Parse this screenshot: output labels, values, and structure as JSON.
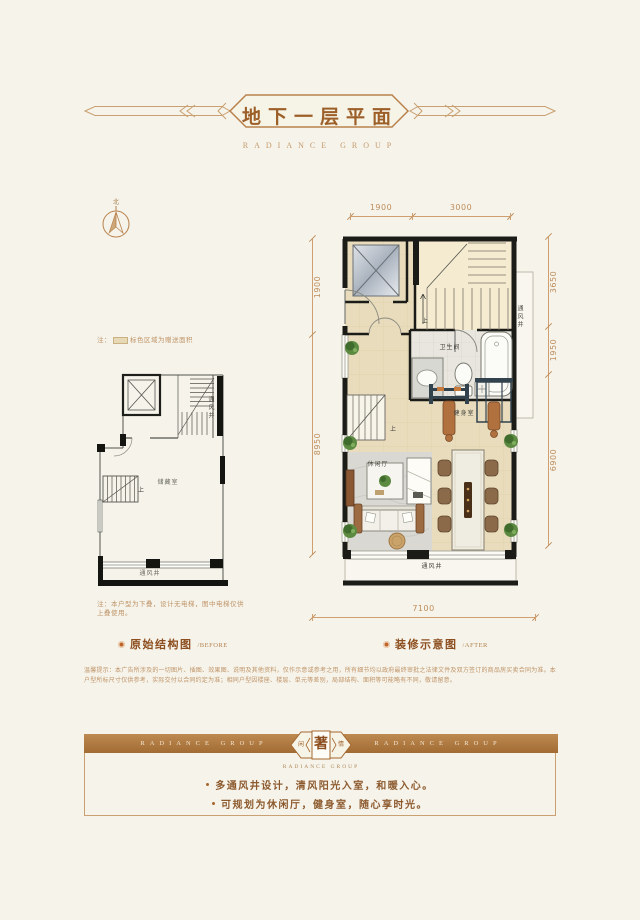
{
  "header": {
    "title": "地下一层平面",
    "brand": "RADIANCE GROUP"
  },
  "compass": {
    "label": "北"
  },
  "plan_before": {
    "note_top_prefix": "注：",
    "note_top_text": "标色区域为赠送面积",
    "room_label": "储藏室",
    "vent_right": "通风井",
    "vent_bottom": "通风井",
    "stair_up": "上",
    "note_bottom": "注：本户型为下叠，设计无电梯，图中电梯仅供上叠使用。",
    "caption": "原始结构图",
    "caption_en": "/BEFORE"
  },
  "plan_after": {
    "bathroom": "卫生间",
    "gym": "健身室",
    "lounge": "休闲厅",
    "vent_right": "通风井",
    "vent_bottom": "通风井",
    "stair_up": "上",
    "stair_up2": "上",
    "caption": "装修示意图",
    "caption_en": "/AFTER",
    "dims": {
      "top1": "1900",
      "top2": "3000",
      "right1": "3650",
      "right2": "1950",
      "right3": "6900",
      "left1": "1900",
      "left2": "8950",
      "bottom1": "7100"
    }
  },
  "disclaimer": "温馨提示：本广告所涉及的一切图片、插图、效果图、说明及其他资料，仅作示意或参考之用，所有细节均以政府最终审批之法律文件及双方签订的商品房买卖合同为准。本户型所标尺寸仅供参考，实际交付以合同约定为准；相同户型因楼座、楼层、单元等差别，局部结构、面积等可能略有不同，敬请留意。",
  "banner": {
    "brand_left": "RADIANCE GROUP",
    "brand_right": "RADIANCE GROUP",
    "logo_left": "闲",
    "logo_main": "著",
    "logo_right": "情",
    "brand_small": "RADIANCE GROUP"
  },
  "features": {
    "item1": "多通风井设计，清风阳光入室，和暖入心。",
    "item2": "可规划为休闲厅，健身室，随心享时光。"
  },
  "colors": {
    "accent": "#a5672f",
    "ornament_line": "#c9a071",
    "wall": "#1b1b18",
    "floor_beige": "#e9dcbd",
    "banner_brown": "#b1793f",
    "background": "#f5f3ea"
  }
}
